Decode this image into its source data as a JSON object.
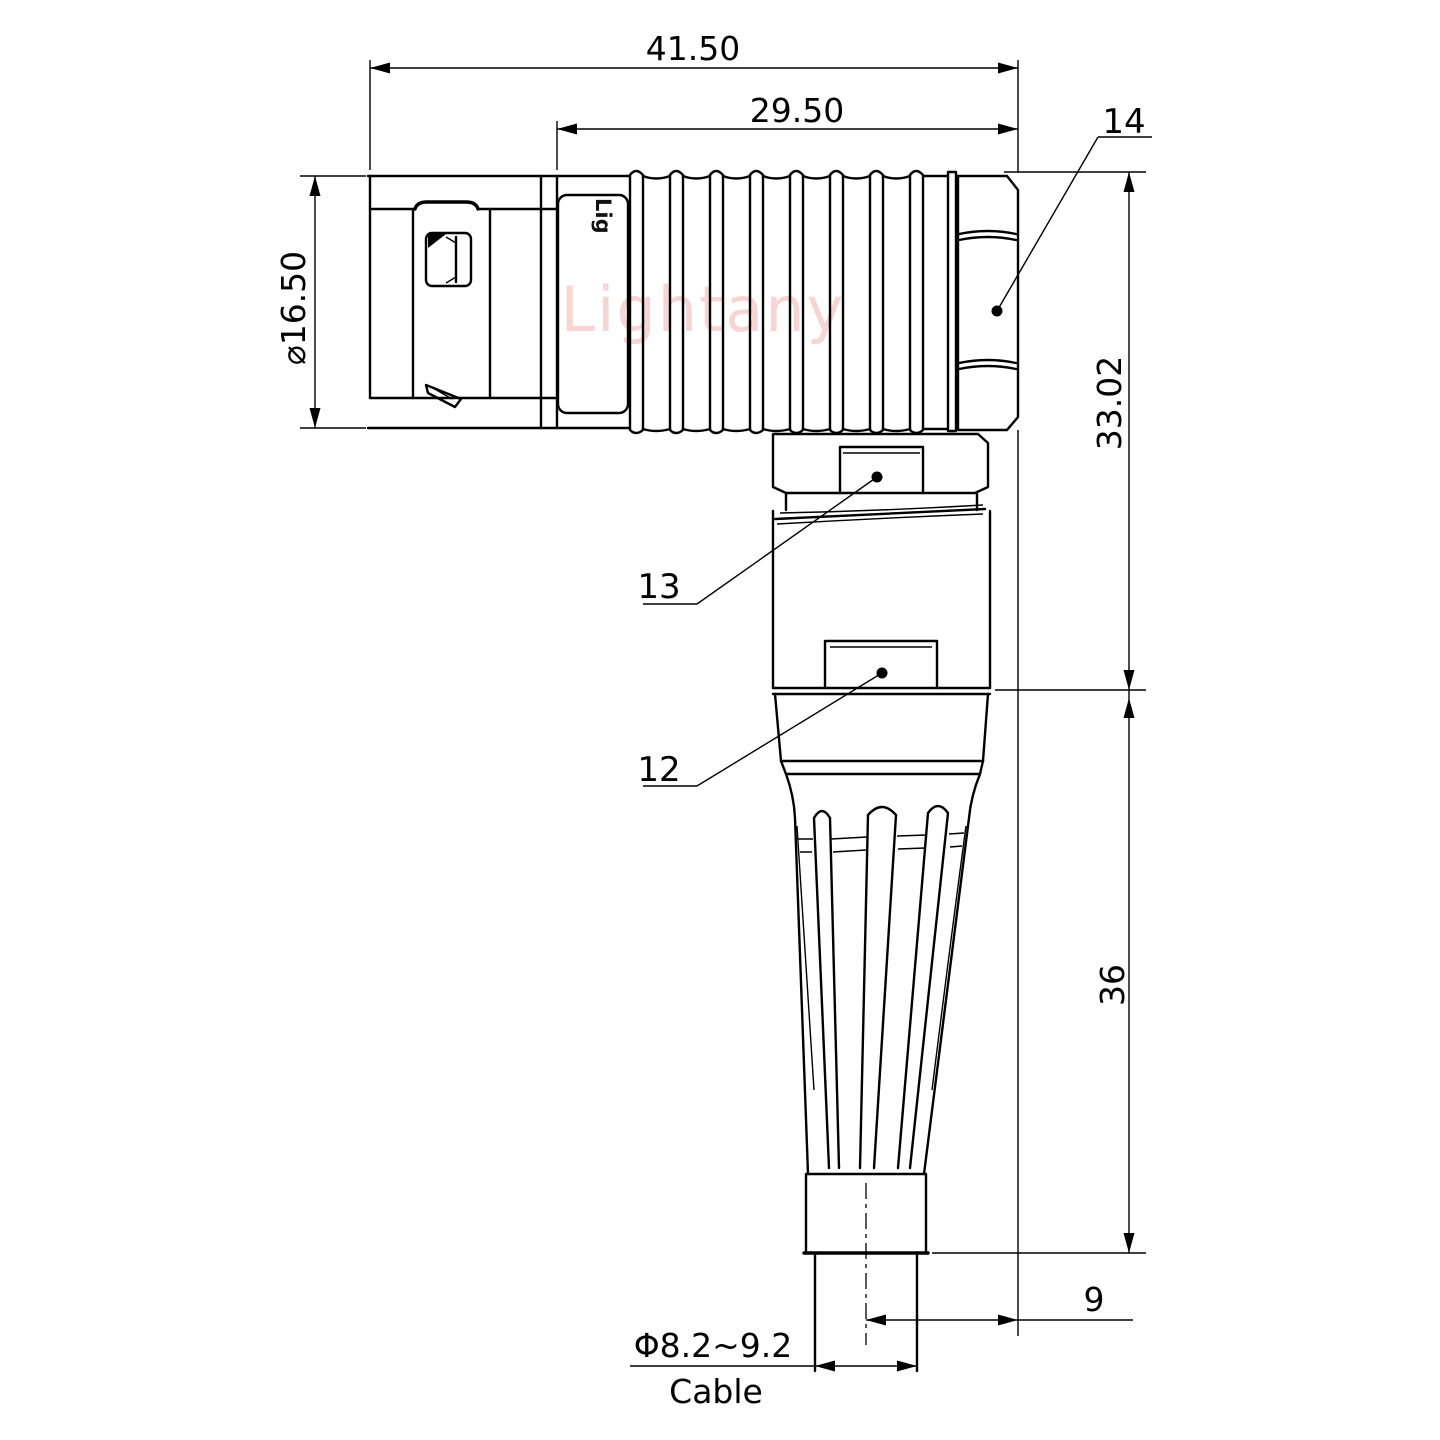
{
  "drawing": {
    "watermark": "Lightany",
    "part_marking": "Lig",
    "dimensions": {
      "overall_length": "41.50",
      "body_length": "29.50",
      "shell_diameter": "⌀16.50",
      "height_upper": "33.02",
      "height_lower": "36",
      "cable_offset": "9",
      "cable_diameter": "Φ8.2~9.2",
      "cable_label": "Cable"
    },
    "callouts": [
      {
        "number": "14",
        "target": "coupling-nut"
      },
      {
        "number": "13",
        "target": "back-nut"
      },
      {
        "number": "12",
        "target": "housing"
      }
    ],
    "colors": {
      "line": "#000000",
      "watermark": "#f7d5d5",
      "background": "#ffffff"
    }
  }
}
